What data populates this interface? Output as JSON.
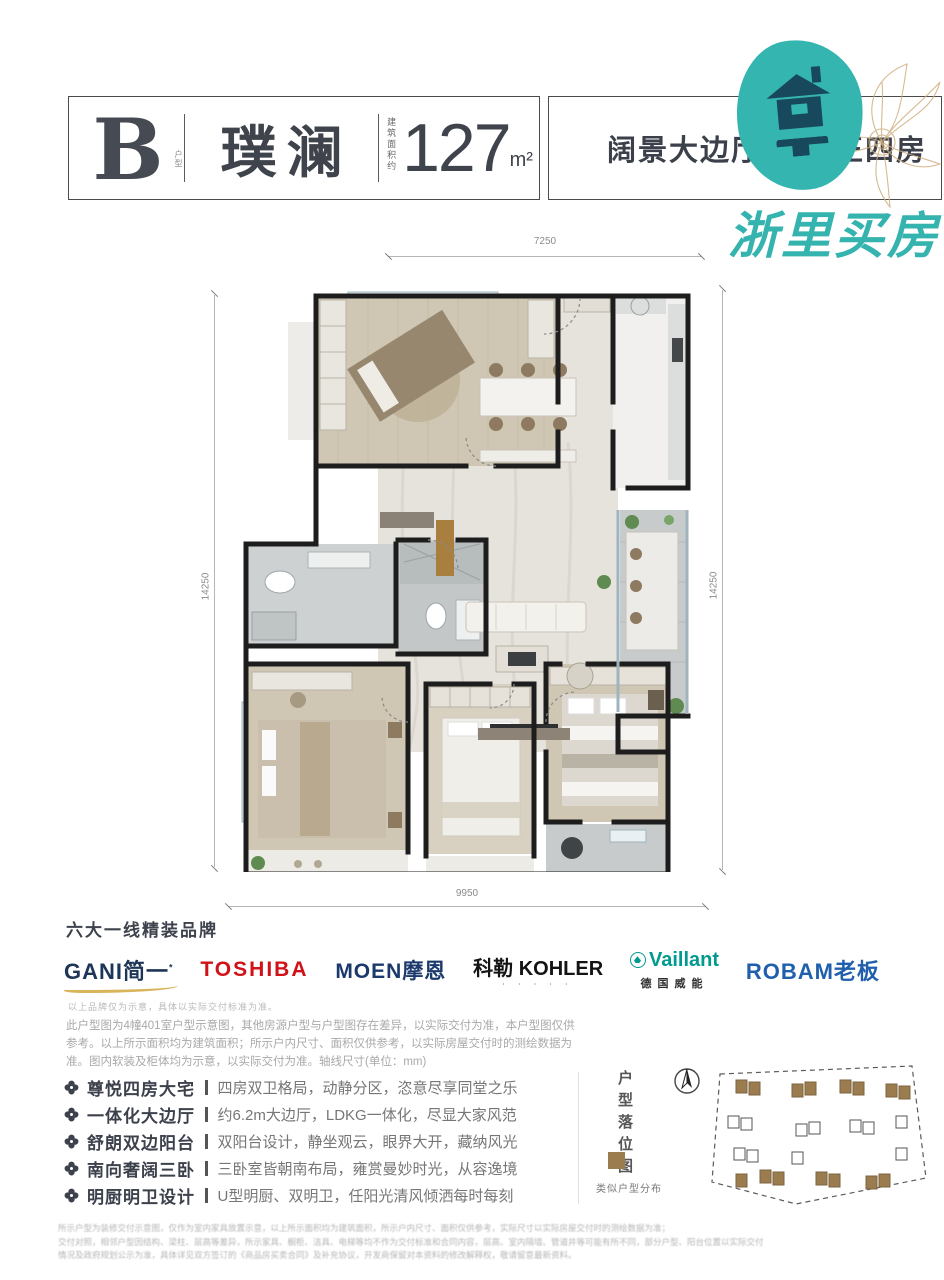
{
  "header": {
    "unit_letter": "B",
    "unit_label": "户型",
    "name": "璞澜",
    "area_prefix": "建筑面积约",
    "area_value": "127",
    "area_unit": "m²",
    "tagline": "阔景大边厅 改善正四房"
  },
  "watermark": "浙里买房",
  "plan": {
    "dim_top": "7250",
    "dim_bottom": "9950",
    "dim_left": "14250",
    "dim_right": "14250"
  },
  "brands": {
    "title": "六大一线精装品牌",
    "note": "以上品牌仅为示意，具体以实际交付标准为准。",
    "items": [
      {
        "name": "GANI简一",
        "mark": "*",
        "color": "#1d3557"
      },
      {
        "name": "TOSHIBA",
        "color": "#d01117"
      },
      {
        "name": "MOEN摩恩",
        "color": "#1b3a6b"
      },
      {
        "name": "科勒 KOHLER",
        "color": "#141414"
      },
      {
        "name": "Vaillant",
        "sub": "德国威能",
        "color": "#009a8e"
      },
      {
        "name": "ROBAM老板",
        "color": "#1f5fae"
      }
    ]
  },
  "disclaimer": "此户型图为4幢401室户型示意图，其他房源户型与户型图存在差异，以实际交付为准，本户型图仅供参考。以上所示面积均为建筑面积；所示户内尺寸、面积仅供参考，以实际房屋交付时的测绘数据为准。图内软装及柜体均为示意，以实际交付为准。轴线尺寸(单位：mm)",
  "features": [
    {
      "title": "尊悦四房大宅",
      "desc": "四房双卫格局，动静分区，恣意尽享同堂之乐"
    },
    {
      "title": "一体化大边厅",
      "desc": "约6.2m大边厅，LDKG一体化，尽显大家风范"
    },
    {
      "title": "舒朗双边阳台",
      "desc": "双阳台设计，静坐观云，眼界大开，藏纳风光"
    },
    {
      "title": "南向奢阔三卧",
      "desc": "三卧室皆朝南布局，雍赏曼妙时光，从容逸境"
    },
    {
      "title": "明厨明卫设计",
      "desc": "U型明厨、双明卫，任阳光清风倾洒每时每刻"
    }
  ],
  "siteplan": {
    "title": "户型落位图",
    "legend": "类似户型分布"
  },
  "fineprint": [
    "所示户型为装修交付示意图，仅作为室内家具放置示意，以上所示面积均为建筑面积，所示户内尺寸、面积仅供参考，实际尺寸以实际房屋交付时的测绘数据为准；",
    "交付对照，相邻户型因结构、梁柱、层高等差异，所示家具、橱柜、洁具、电梯等均不作为交付标准和合同内容，层高、室内隔墙、管道井等可能有所不同，部分户型、阳台位置以实际交付",
    "情况及政府规划公示为准，具体详见双方签订的《商品房买卖合同》及补充协议，开发商保留对本资料的修改解释权，敬请留意最新资料。"
  ],
  "colors": {
    "accent_teal": "#35b5b0",
    "accent_gold": "#d8b45a",
    "legend_brown": "#9b7c4e",
    "text_dark": "#3c414c"
  }
}
